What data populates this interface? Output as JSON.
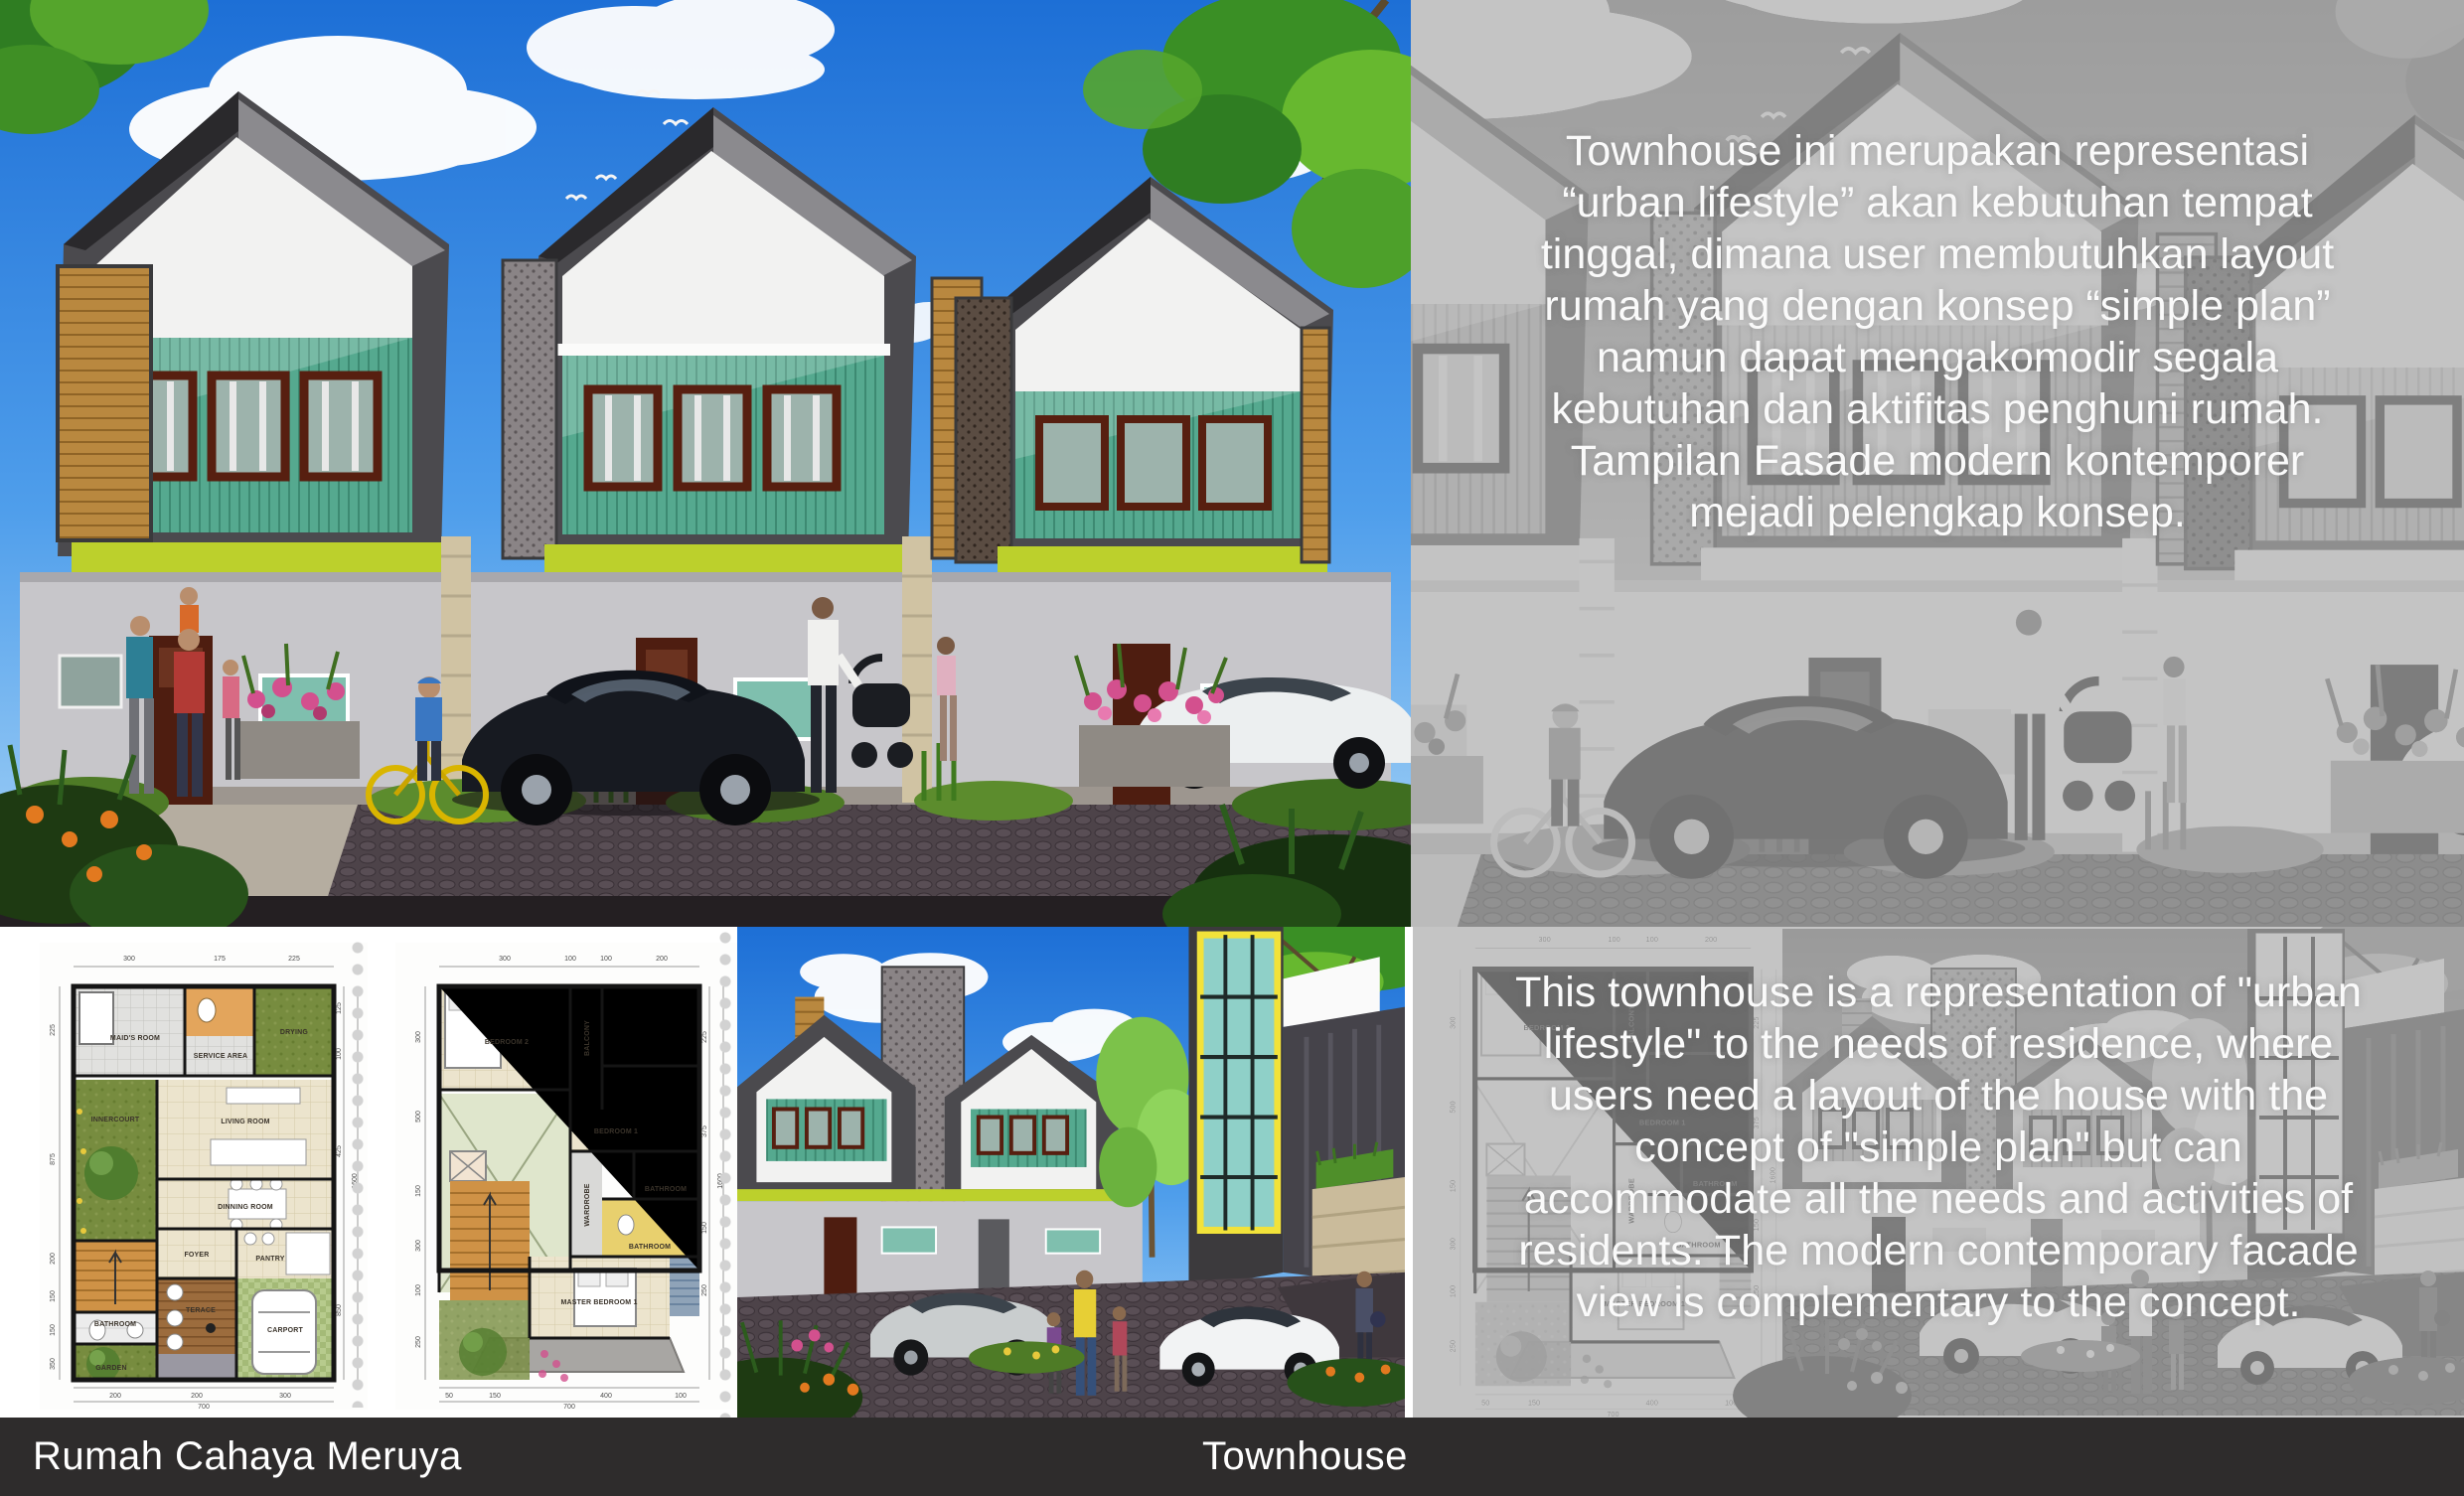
{
  "footer": {
    "project_title": "Rumah Cahaya Meruya",
    "category": "Townhouse"
  },
  "panels": {
    "indonesian": {
      "lines": [
        "Townhouse ini merupakan representasi",
        "“urban lifestyle” akan kebutuhan tempat",
        "tinggal, dimana user membutuhkan layout",
        "rumah yang dengan konsep “simple plan”",
        "namun dapat mengakomodir segala",
        "kebutuhan dan aktifitas penghuni rumah.",
        "Tampilan Fasade modern kontemporer",
        "mejadi pelengkap konsep."
      ]
    },
    "english": {
      "lines": [
        "This townhouse is a representation of \"urban",
        "lifestyle\" to the needs of residence, where",
        "users need a layout of the house with the",
        "concept of \"simple plan\" but can",
        "accommodate all the needs and activities of",
        "residents. The modern contemporary facade",
        "view is complementary to the concept."
      ]
    }
  },
  "plans": {
    "plan1": {
      "rooms": {
        "maids": "MAID'S ROOM",
        "service": "SERVICE AREA",
        "drying": "DRYING",
        "innercourt": "INNERCOURT",
        "living": "LIVING ROOM",
        "dinning": "DINNING ROOM",
        "foyer": "FOYER",
        "pantry": "PANTRY",
        "bathroom": "BATHROOM",
        "terrace": "TERACE",
        "garden": "GARDEN",
        "carport": "CARPORT"
      },
      "dims_top": [
        "300",
        "175",
        "225"
      ],
      "dims_left": [
        "225",
        "875",
        "200",
        "150",
        "150",
        "350"
      ],
      "dims_right": [
        "125",
        "100",
        "425",
        "850"
      ],
      "dims_bottom": [
        "200",
        "200",
        "300"
      ],
      "total_width": "700",
      "total_height": "1600"
    },
    "plan2": {
      "rooms": {
        "bedroom2": "BEDROOM 2",
        "balcony": "BALCONY",
        "bedroom1": "BEDROOM 1",
        "bathroom_a": "BATHROOM",
        "wardrobe": "WARDROBE",
        "bathroom_b": "BATHROOM",
        "master": "MASTER BEDROOM 1"
      },
      "dims_top": [
        "300",
        "100",
        "100",
        "200"
      ],
      "dims_left": [
        "300",
        "500",
        "150",
        "300",
        "100",
        "250"
      ],
      "dims_right": [
        "225",
        "375",
        "150",
        "250"
      ],
      "dims_bottom": [
        "50",
        "150",
        "400",
        "100"
      ],
      "total_width": "700",
      "total_height": "1600"
    }
  },
  "colors": {
    "sky": "#2f86e3",
    "teal_siding": "#55a98f",
    "lime_accent": "#bcd02c",
    "wood": "#b9883f",
    "charcoal_frame": "#4b4a4e",
    "panel_gray": "#b2b2b2",
    "footer_bar": "#2e2c2c",
    "text_white": "#ffffff"
  }
}
